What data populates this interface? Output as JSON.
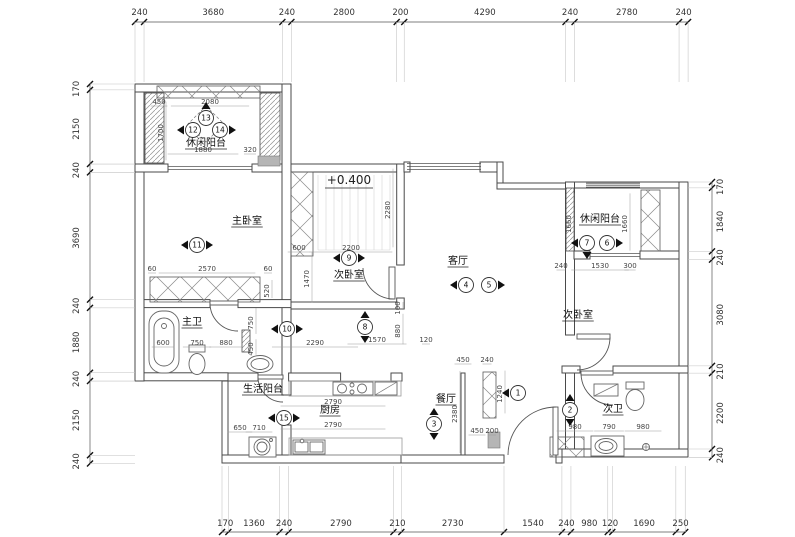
{
  "rooms": [
    {
      "label": "休闲阳台",
      "x": 206,
      "y": 146
    },
    {
      "label": "主卧室",
      "x": 247,
      "y": 224
    },
    {
      "label": "次卧室",
      "x": 349,
      "y": 278
    },
    {
      "label": "客厅",
      "x": 458,
      "y": 264
    },
    {
      "label": "休闲阳台",
      "x": 600,
      "y": 222
    },
    {
      "label": "次卧室",
      "x": 578,
      "y": 318
    },
    {
      "label": "主卫",
      "x": 192,
      "y": 325
    },
    {
      "label": "生活阳台",
      "x": 263,
      "y": 392
    },
    {
      "label": "厨房",
      "x": 330,
      "y": 413
    },
    {
      "label": "餐厅",
      "x": 446,
      "y": 402
    },
    {
      "label": "次卫",
      "x": 613,
      "y": 412
    }
  ],
  "elevation_note": {
    "text": "+0.400",
    "x": 349,
    "y": 184
  },
  "markers": [
    {
      "n": "1",
      "x": 518,
      "y": 393,
      "t": "l"
    },
    {
      "n": "2",
      "x": 570,
      "y": 410,
      "t": "ud"
    },
    {
      "n": "3",
      "x": 434,
      "y": 424,
      "t": "ud"
    },
    {
      "n": "4",
      "x": 466,
      "y": 285,
      "t": "l"
    },
    {
      "n": "5",
      "x": 489,
      "y": 285,
      "t": "r"
    },
    {
      "n": "6",
      "x": 607,
      "y": 243,
      "t": "r"
    },
    {
      "n": "7",
      "x": 587,
      "y": 243,
      "t": "ld"
    },
    {
      "n": "8",
      "x": 365,
      "y": 327,
      "t": "ud"
    },
    {
      "n": "9",
      "x": 349,
      "y": 258,
      "t": "lr"
    },
    {
      "n": "10",
      "x": 287,
      "y": 329,
      "t": "lr"
    },
    {
      "n": "11",
      "x": 197,
      "y": 245,
      "t": "lr"
    },
    {
      "n": "12",
      "x": 193,
      "y": 130,
      "t": "l"
    },
    {
      "n": "13",
      "x": 206,
      "y": 118,
      "t": "u"
    },
    {
      "n": "14",
      "x": 220,
      "y": 130,
      "t": "r"
    },
    {
      "n": "15",
      "x": 284,
      "y": 418,
      "t": "lr"
    }
  ],
  "dim_chains": {
    "top": {
      "values": [
        240,
        3680,
        240,
        2800,
        200,
        4290,
        240,
        2780,
        240
      ]
    },
    "left": {
      "values": [
        170,
        2150,
        240,
        3690,
        240,
        1880,
        240,
        2150,
        240
      ]
    },
    "right": {
      "values": [
        170,
        1840,
        240,
        3080,
        210,
        2200,
        240
      ]
    },
    "bottom": {
      "values": [
        170,
        1360,
        240,
        2790,
        210,
        2730,
        1540,
        240,
        980,
        120,
        1690,
        250
      ]
    }
  },
  "interior_dims": [
    {
      "v": "450",
      "x": 159,
      "y": 104,
      "o": "h"
    },
    {
      "v": "2080",
      "x": 210,
      "y": 104,
      "o": "h"
    },
    {
      "v": "1700",
      "x": 163,
      "y": 131,
      "o": "v"
    },
    {
      "v": "1880",
      "x": 203,
      "y": 152,
      "o": "h"
    },
    {
      "v": "320",
      "x": 250,
      "y": 152,
      "o": "h"
    },
    {
      "v": "60",
      "x": 152,
      "y": 271,
      "o": "h"
    },
    {
      "v": "2570",
      "x": 207,
      "y": 271,
      "o": "h"
    },
    {
      "v": "60",
      "x": 268,
      "y": 271,
      "o": "h"
    },
    {
      "v": "520",
      "x": 269,
      "y": 289,
      "o": "v"
    },
    {
      "v": "600",
      "x": 163,
      "y": 345,
      "o": "h"
    },
    {
      "v": "750",
      "x": 197,
      "y": 345,
      "o": "h"
    },
    {
      "v": "880",
      "x": 226,
      "y": 345,
      "o": "h"
    },
    {
      "v": "2290",
      "x": 315,
      "y": 345,
      "o": "h"
    },
    {
      "v": "750",
      "x": 253,
      "y": 321,
      "o": "v"
    },
    {
      "v": "450",
      "x": 253,
      "y": 347,
      "o": "v"
    },
    {
      "v": "2280",
      "x": 390,
      "y": 208,
      "o": "v"
    },
    {
      "v": "600",
      "x": 299,
      "y": 250,
      "o": "h"
    },
    {
      "v": "2200",
      "x": 351,
      "y": 250,
      "o": "h"
    },
    {
      "v": "1470",
      "x": 309,
      "y": 277,
      "o": "v"
    },
    {
      "v": "1570",
      "x": 377,
      "y": 342,
      "o": "h"
    },
    {
      "v": "120",
      "x": 426,
      "y": 342,
      "o": "h"
    },
    {
      "v": "100",
      "x": 400,
      "y": 306,
      "o": "v"
    },
    {
      "v": "880",
      "x": 400,
      "y": 329,
      "o": "v"
    },
    {
      "v": "450",
      "x": 463,
      "y": 362,
      "o": "h"
    },
    {
      "v": "240",
      "x": 487,
      "y": 362,
      "o": "h"
    },
    {
      "v": "1240",
      "x": 502,
      "y": 392,
      "o": "v"
    },
    {
      "v": "2380",
      "x": 457,
      "y": 412,
      "o": "v"
    },
    {
      "v": "450",
      "x": 477,
      "y": 433,
      "o": "h"
    },
    {
      "v": "200",
      "x": 492,
      "y": 433,
      "o": "h"
    },
    {
      "v": "1660",
      "x": 571,
      "y": 222,
      "o": "v"
    },
    {
      "v": "1660",
      "x": 627,
      "y": 222,
      "o": "v"
    },
    {
      "v": "240",
      "x": 561,
      "y": 268,
      "o": "h"
    },
    {
      "v": "1530",
      "x": 600,
      "y": 268,
      "o": "h"
    },
    {
      "v": "300",
      "x": 630,
      "y": 268,
      "o": "h"
    },
    {
      "v": "980",
      "x": 575,
      "y": 429,
      "o": "h"
    },
    {
      "v": "790",
      "x": 609,
      "y": 429,
      "o": "h"
    },
    {
      "v": "980",
      "x": 643,
      "y": 429,
      "o": "h"
    },
    {
      "v": "2790",
      "x": 333,
      "y": 404,
      "o": "h"
    },
    {
      "v": "2790",
      "x": 333,
      "y": 427,
      "o": "h"
    },
    {
      "v": "650",
      "x": 240,
      "y": 430,
      "o": "h"
    },
    {
      "v": "710",
      "x": 259,
      "y": 430,
      "o": "h"
    }
  ]
}
